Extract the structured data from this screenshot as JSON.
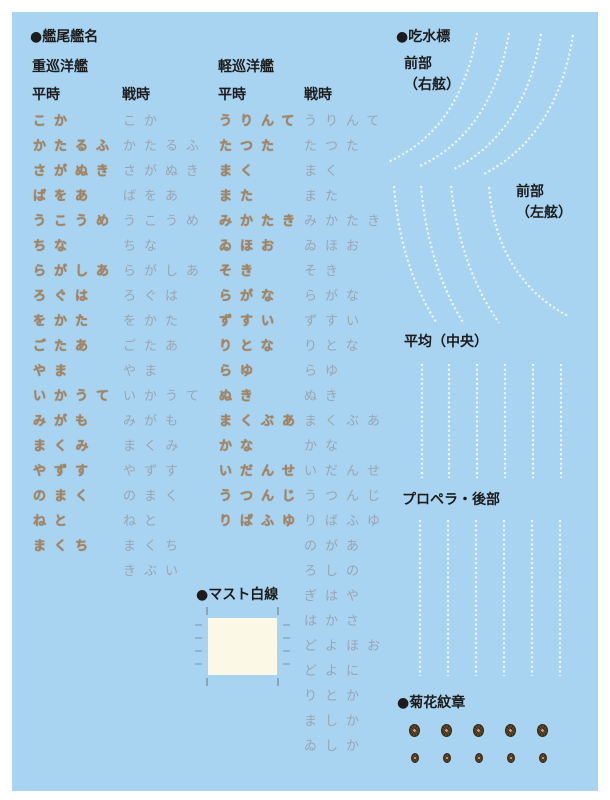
{
  "sheet": {
    "bg": "#a9d4f1",
    "border": "#ffffff"
  },
  "stern_names": {
    "title": "●艦尾艦名",
    "heavy_class_label": "重巡洋艦",
    "light_class_label": "軽巡洋艦",
    "peacetime_header": "平時",
    "wartime_header": "戦時",
    "heavy_peacetime_gold": [
      "こか",
      "かたるふ",
      "さがぬき",
      "ばをあ",
      "うこうめ",
      "ちな",
      "らがしあ",
      "ろぐは",
      "をかた",
      "ごたあ",
      "やま",
      "いかうて",
      "みがも",
      "まくみ",
      "やずす",
      "のまく",
      "ねと",
      "まくち"
    ],
    "heavy_wartime_gray": [
      "こか",
      "かたるふ",
      "さがぬき",
      "ばをあ",
      "うこうめ",
      "ちな",
      "らがしあ",
      "ろぐは",
      "をかた",
      "ごたあ",
      "やま",
      "いかうて",
      "みがも",
      "まくみ",
      "やずす",
      "のまく",
      "ねと",
      "まくち",
      "きぶい"
    ],
    "light_peacetime_gold": [
      "うりんて",
      "たつた",
      "まく",
      "また",
      "みかたき",
      "ゐほお",
      "そき",
      "らがな",
      "ずすい",
      "りとな",
      "らゆ",
      "ぬき",
      "まくぶあ",
      "かな",
      "いだんせ",
      "うつんじ",
      "りばふゆ"
    ],
    "light_wartime_gray": [
      "うりんて",
      "たつた",
      "まく",
      "また",
      "みかたき",
      "ゐほお",
      "そき",
      "らがな",
      "ずすい",
      "りとな",
      "らゆ",
      "ぬき",
      "まくぶあ",
      "かな",
      "いだんせ",
      "うつんじ",
      "りばふゆ",
      "のがあ",
      "ろしの",
      "ぎはや",
      "はかさ",
      "どよほお",
      "どよに",
      "りとか",
      "ましか",
      "ゐしか"
    ],
    "gold_color": "#a5835f",
    "gray_color": "#98a5b1"
  },
  "draft_marks": {
    "title": "●吃水標",
    "front_starboard_label": "前部\n（右舷）",
    "front_port_label": "前部\n（左舷）",
    "average_label": "平均（中央）",
    "propeller_label": "プロペラ・後部",
    "dot_color": "#f2f8fc"
  },
  "mast": {
    "title": "●マスト白線",
    "fill": "#fbf8e6"
  },
  "crest": {
    "title": "●菊花紋章",
    "emblem_rows": [
      {
        "count": 5,
        "size": "large"
      },
      {
        "count": 5,
        "size": "small"
      }
    ],
    "gold_color": "#c9a45f",
    "dark_color": "#3a2b1c"
  }
}
